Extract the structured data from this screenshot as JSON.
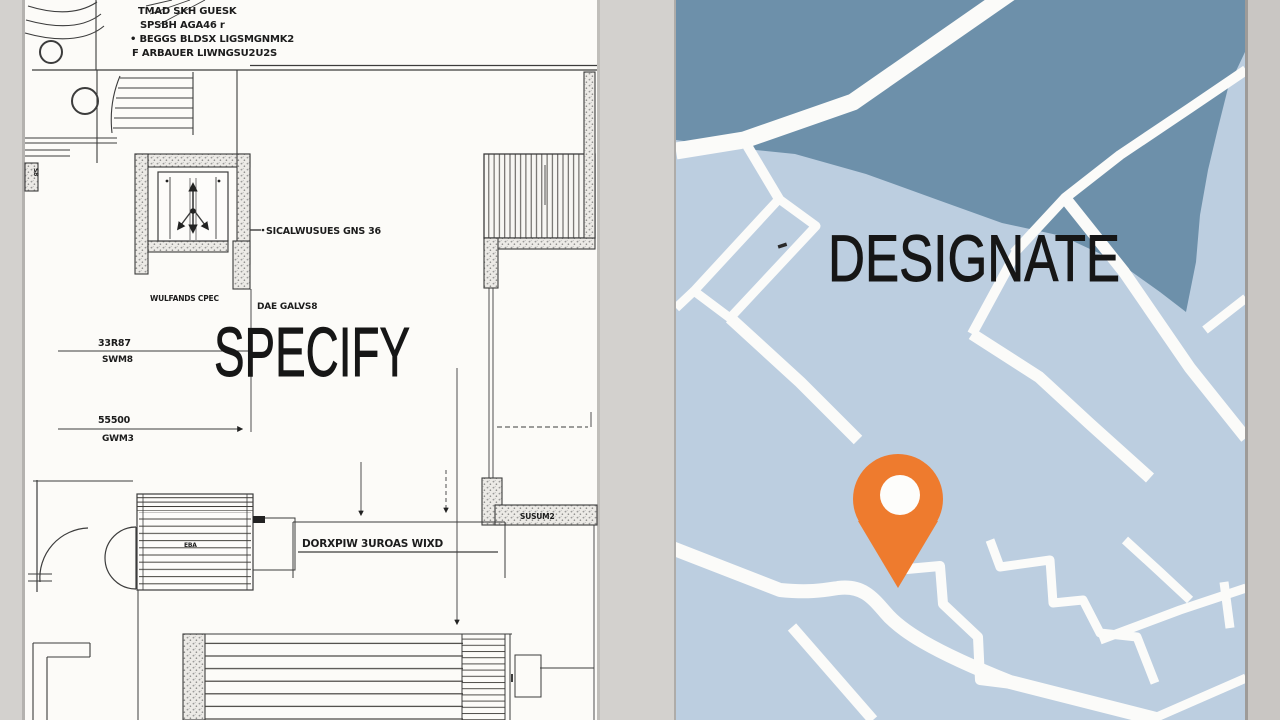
{
  "left_panel": {
    "word": "SPECIFY",
    "notes": [
      "TMAD SKH GUESK",
      "SPSBH AGA46 r",
      "• BEGGS BLDSX LIGSMGNMK2",
      "F ARBAUER LIWNGSU2U2S"
    ],
    "labels": {
      "core_leader": "SICALWUSUES GNS 36",
      "core_under": "WULFANDS CPEC",
      "galv": "DAE GALVS8",
      "dim1_value": "33R87",
      "dim1_sub": "SWM8",
      "dim2_value": "55500",
      "dim2_sub": "GWM3",
      "room_note": "DORXPIW 3UROAS WIXD",
      "wall_note": "SUSUM2",
      "stair_note": "EBA",
      "edge_note": "S8"
    }
  },
  "right_panel": {
    "word": "DESIGNATE"
  },
  "colors": {
    "canvas_bg": "#d3d1ce",
    "page": "#fcfbf8",
    "ink": "#3c3c3c",
    "map_land": "#bccee0",
    "map_water": "#6d90aa",
    "map_road": "#fbfbf9",
    "pin": "#ee7b2e",
    "title_ink": "#161616"
  }
}
